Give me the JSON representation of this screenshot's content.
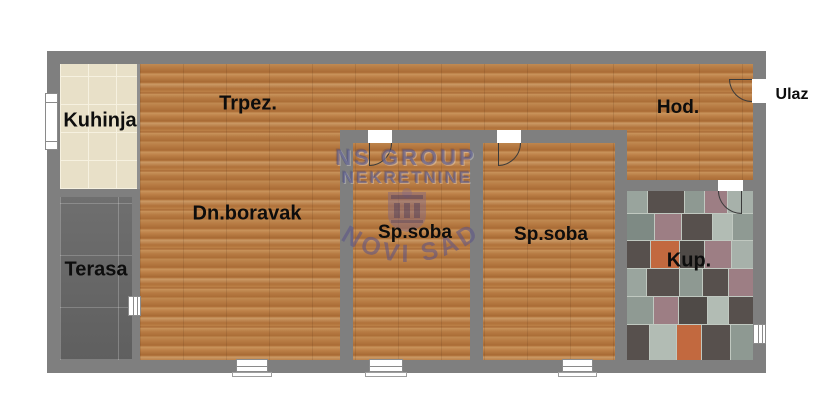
{
  "rooms": [
    {
      "id": "kitchen",
      "label": "Kuhinja",
      "floor": "beige-tile"
    },
    {
      "id": "dining",
      "label": "Trpez.",
      "floor": "wood"
    },
    {
      "id": "living",
      "label": "Dn.boravak",
      "floor": "wood"
    },
    {
      "id": "terrace",
      "label": "Terasa",
      "floor": "dark-tile"
    },
    {
      "id": "bedroom1",
      "label": "Sp.soba",
      "floor": "wood"
    },
    {
      "id": "bedroom2",
      "label": "Sp.soba",
      "floor": "wood"
    },
    {
      "id": "bathroom",
      "label": "Kup.",
      "floor": "mosaic-tile"
    },
    {
      "id": "hallway",
      "label": "Hod.",
      "floor": "wood"
    },
    {
      "id": "entrance",
      "label": "Ulaz",
      "floor": "outside"
    }
  ],
  "watermark": {
    "line1": "NS GROUP",
    "line2": "NEKRETNINE",
    "arc": "NOVI SAD"
  },
  "colors": {
    "wall": "#7f7f7f",
    "wood_base": "#b67c44",
    "kitchen_tile": "#e8e0c8",
    "terrace_tile": "#696969",
    "mosaic_light": "#b2bcb4",
    "mosaic_mid": "#8e9992",
    "mosaic_dark": "#57504d",
    "mosaic_mauve": "#9d7e84",
    "mosaic_orange": "#c2693f",
    "watermark": "#54588c",
    "label_text": "#0d0d0d"
  }
}
